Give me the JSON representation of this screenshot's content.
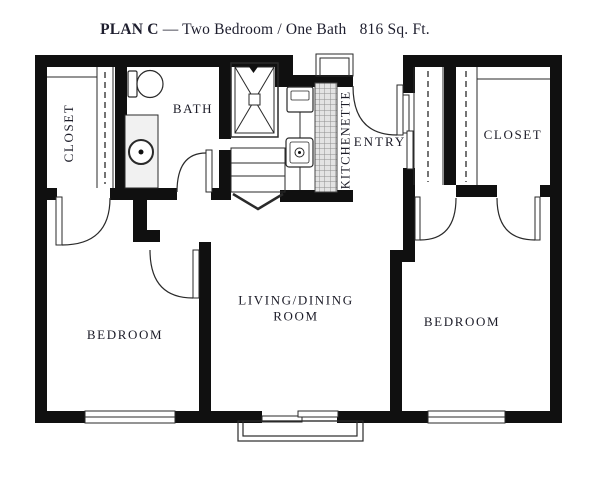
{
  "title": {
    "plan": "PLAN C",
    "desc": "— Two Bedroom / One Bath",
    "area": "816 Sq. Ft."
  },
  "rooms": {
    "closet_left": "CLOSET",
    "bath": "BATH",
    "kitchenette": "KITCHENETTE",
    "entry": "ENTRY",
    "closet_right": "CLOSET",
    "bedroom_left": "BEDROOM",
    "living_line1": "LIVING/DINING",
    "living_line2": "ROOM",
    "bedroom_right": "BEDROOM"
  },
  "colors": {
    "wall": "#101010",
    "thin_line": "#2a2a2a",
    "text": "#1c1c28",
    "hatch_bg": "#e3e3e3",
    "hatch_line": "#8f8f8f"
  }
}
